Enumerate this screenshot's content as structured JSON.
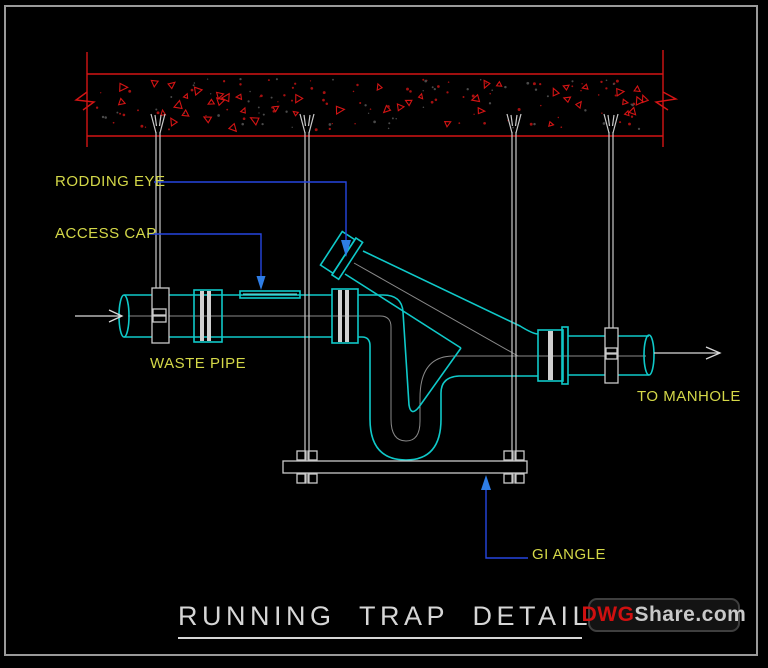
{
  "drawing": {
    "title": "RUNNING TRAP DETAILS",
    "labels": {
      "rodding_eye": "RODDING EYE",
      "access_cap": "ACCESS CAP",
      "waste_pipe": "WASTE PIPE",
      "to_manhole": "TO MANHOLE",
      "gi_angle": "GI ANGLE"
    },
    "watermark": {
      "prefix": "DWG",
      "suffix": "Share.com"
    },
    "colors": {
      "background": "#000000",
      "pipe_cyan": "#0fc9c9",
      "label_yellow": "#d4d848",
      "leader_blue": "#2646e0",
      "leader_arrow": "#2e7de6",
      "slab_red": "#d41414",
      "hardware_gray": "#c9c9c9",
      "centerline_gray": "#8a8a8a",
      "title_white": "#d6d6d6",
      "logo_red": "#cf1010",
      "frame_gray": "#9a9a9a"
    }
  }
}
